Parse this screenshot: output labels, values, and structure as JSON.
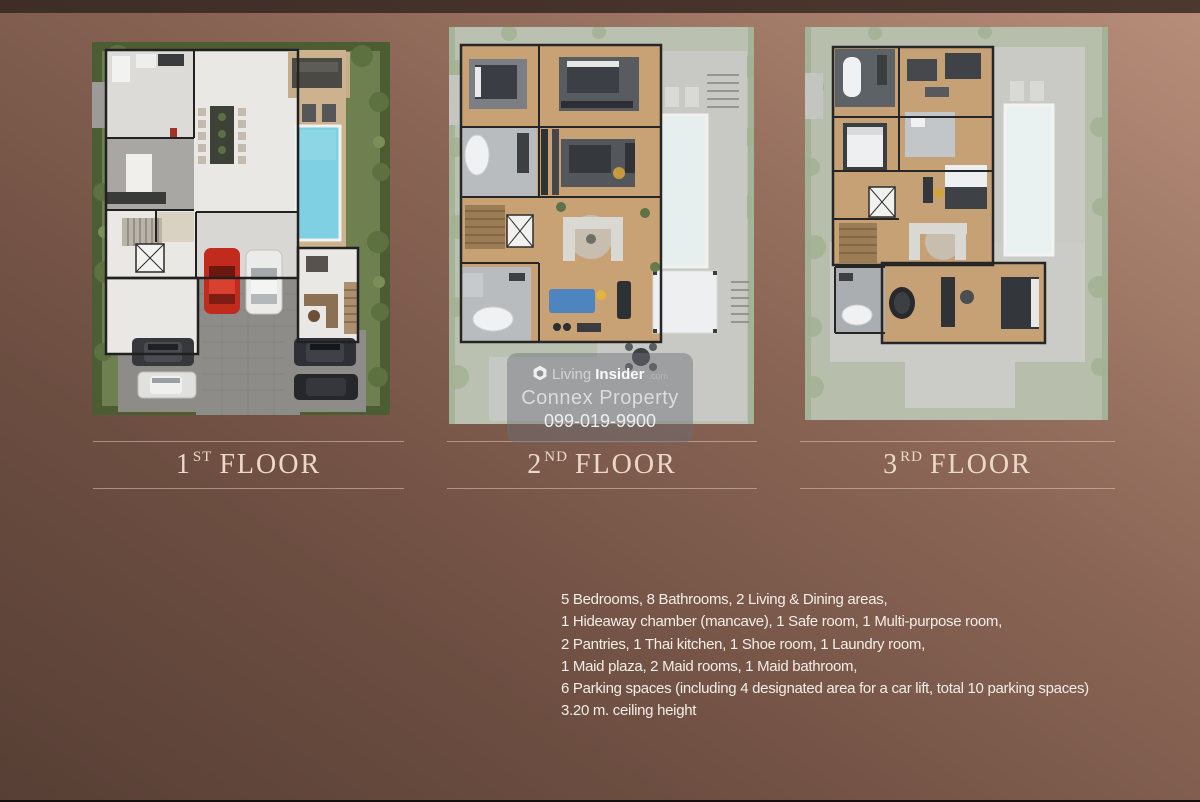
{
  "floors": [
    {
      "number": "1",
      "ordinal": "ST",
      "word": "FLOOR"
    },
    {
      "number": "2",
      "ordinal": "ND",
      "word": "FLOOR"
    },
    {
      "number": "3",
      "ordinal": "RD",
      "word": "FLOOR"
    }
  ],
  "watermark": {
    "brand_first": "Living",
    "brand_second": "Insider",
    "brand_tld": ".com",
    "company": "Connex Property",
    "phone": "099-019-9900"
  },
  "details": {
    "lines": [
      "5 Bedrooms, 8 Bathrooms, 2 Living & Dining areas,",
      "1 Hideaway chamber (mancave), 1 Safe room, 1 Multi-purpose room,",
      "2 Pantries, 1 Thai kitchen, 1 Shoe room, 1 Laundry room,",
      "1 Maid plaza, 2 Maid rooms, 1 Maid bathroom,",
      "6 Parking spaces (including 4 designated area for a car lift, total 10 parking spaces)",
      "3.20 m. ceiling height"
    ]
  },
  "colors": {
    "background_bottom_left": "#573f35",
    "background_top_right": "#b78e7a",
    "top_band": "#43322b",
    "floor_label_text": "#ecd8c8",
    "divider_line": "#e9d2c3",
    "details_text": "#f3ede7",
    "watermark_background": "rgba(106,108,118,0.45)",
    "pool_blue": "#7ed0e2",
    "lawn_green": "#6e7f50",
    "red_car": "#c02b1e"
  }
}
